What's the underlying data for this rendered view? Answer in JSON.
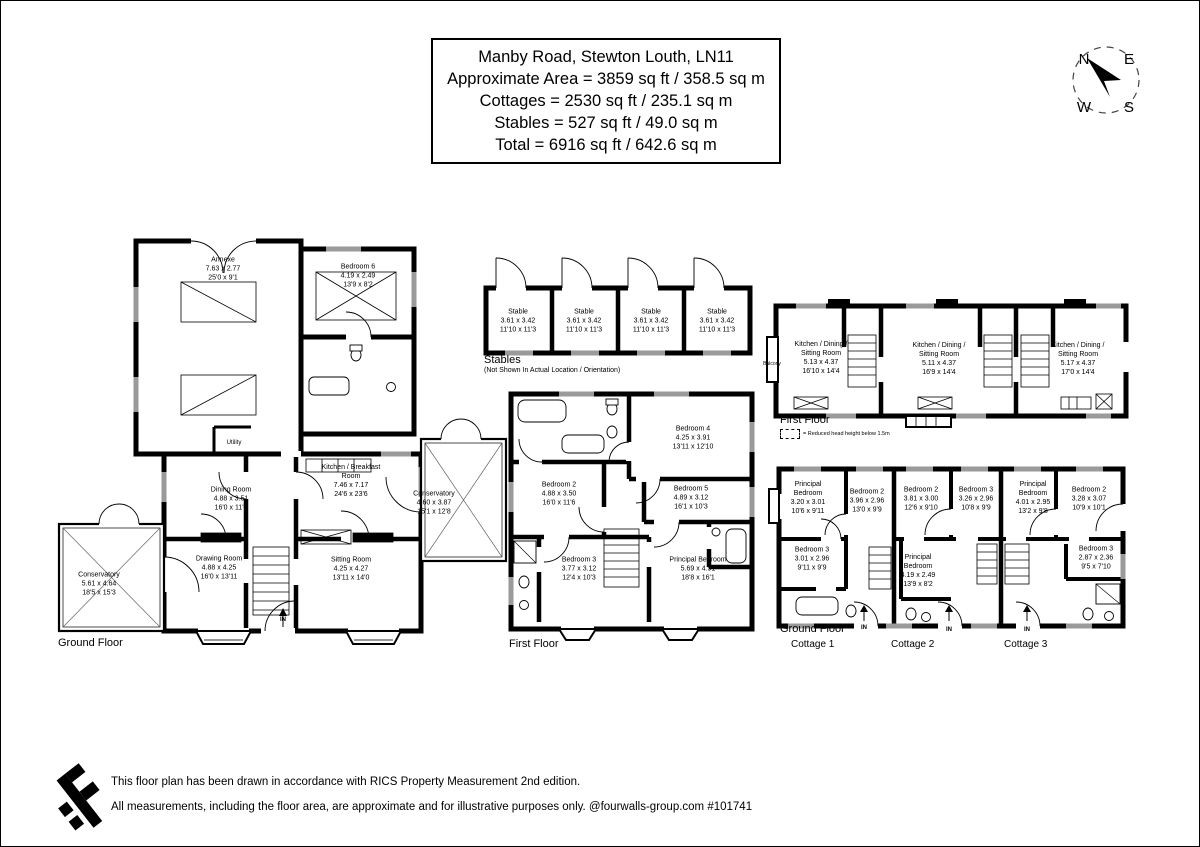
{
  "title_box": {
    "line1": "Manby Road, Stewton Louth, LN11",
    "line2": "Approximate Area = 3859 sq ft / 358.5 sq m",
    "line3": "Cottages = 2530 sq ft / 235.1 sq m",
    "line4": "Stables = 527 sq ft / 49.0 sq m",
    "line5": "Total = 6916 sq ft / 642.6 sq m"
  },
  "compass": {
    "n": "N",
    "e": "E",
    "w": "W",
    "s": "S"
  },
  "colors": {
    "wall": "#000000",
    "window": "#9a9a9a",
    "background": "#ffffff"
  },
  "plans": {
    "main_ground": {
      "caption": "Ground Floor",
      "entrance_label": "IN",
      "rooms": [
        {
          "name": "Annexe",
          "metric": "7.63 x 2.77",
          "imperial": "25'0 x 9'1"
        },
        {
          "name": "Bedroom 6",
          "metric": "4.19 x 2.49",
          "imperial": "13'9 x 8'2"
        },
        {
          "name": "Utility",
          "metric": "",
          "imperial": ""
        },
        {
          "name": "Dining Room",
          "metric": "4.88 x 3.51",
          "imperial": "16'0 x 11'6"
        },
        {
          "name": "Kitchen / Breakfast Room",
          "metric": "7.46 x 7.17",
          "imperial": "24'6 x 23'6"
        },
        {
          "name": "Drawing Room",
          "metric": "4.88 x 4.25",
          "imperial": "16'0 x 13'11"
        },
        {
          "name": "Sitting Room",
          "metric": "4.25 x 4.27",
          "imperial": "13'11 x 14'0"
        },
        {
          "name": "Conservatory",
          "metric": "4.60 x 3.87",
          "imperial": "15'1 x 12'8"
        },
        {
          "name": "Conservatory",
          "metric": "5.61 x 4.64",
          "imperial": "18'5 x 15'3"
        }
      ]
    },
    "main_first": {
      "caption": "First Floor",
      "rooms": [
        {
          "name": "Bedroom 4",
          "metric": "4.25 x 3.91",
          "imperial": "13'11 x 12'10"
        },
        {
          "name": "Bedroom 2",
          "metric": "4.88 x 3.50",
          "imperial": "16'0 x 11'6"
        },
        {
          "name": "Bedroom 5",
          "metric": "4.89 x 3.12",
          "imperial": "16'1 x 10'3"
        },
        {
          "name": "Bedroom 3",
          "metric": "3.77 x 3.12",
          "imperial": "12'4 x 10'3"
        },
        {
          "name": "Principal Bedroom",
          "metric": "5.69 x 4.91",
          "imperial": "18'8 x 16'1"
        }
      ]
    },
    "stables": {
      "caption": "Stables",
      "subcaption": "(Not Shown In Actual Location / Orientation)",
      "stalls": [
        {
          "name": "Stable",
          "metric": "3.61 x 3.42",
          "imperial": "11'10 x 11'3"
        },
        {
          "name": "Stable",
          "metric": "3.61 x 3.42",
          "imperial": "11'10 x 11'3"
        },
        {
          "name": "Stable",
          "metric": "3.61 x 3.42",
          "imperial": "11'10 x 11'3"
        },
        {
          "name": "Stable",
          "metric": "3.61 x 3.42",
          "imperial": "11'10 x 11'3"
        }
      ]
    },
    "cottages_first": {
      "caption": "First Floor",
      "legend_text": "= Reduced head height below 1.5m",
      "balcony_label": "Balcony",
      "rooms": [
        {
          "name": "Kitchen / Dining / Sitting Room",
          "metric": "5.13 x 4.37",
          "imperial": "16'10 x 14'4"
        },
        {
          "name": "Kitchen / Dining / Sitting Room",
          "metric": "5.11 x 4.37",
          "imperial": "16'9 x 14'4"
        },
        {
          "name": "Kitchen / Dining / Sitting Room",
          "metric": "5.17 x 4.37",
          "imperial": "17'0 x 14'4"
        }
      ]
    },
    "cottages_ground": {
      "caption": "Ground Floor",
      "entrance_label": "IN",
      "cottage_labels": [
        "Cottage 1",
        "Cottage 2",
        "Cottage 3"
      ],
      "rooms": [
        {
          "name": "Principal Bedroom",
          "metric": "3.20 x 3.01",
          "imperial": "10'6 x 9'11"
        },
        {
          "name": "Bedroom 2",
          "metric": "3.96 x 2.96",
          "imperial": "13'0 x 9'9"
        },
        {
          "name": "Bedroom 3",
          "metric": "3.01 x 2.96",
          "imperial": "9'11 x 9'9"
        },
        {
          "name": "Bedroom 2",
          "metric": "3.81 x 3.00",
          "imperial": "12'6 x 9'10"
        },
        {
          "name": "Principal Bedroom",
          "metric": "4.19 x 2.49",
          "imperial": "13'9 x 8'2"
        },
        {
          "name": "Bedroom 3",
          "metric": "3.26 x 2.96",
          "imperial": "10'8 x 9'9"
        },
        {
          "name": "Principal Bedroom",
          "metric": "4.01 x 2.95",
          "imperial": "13'2 x 9'8"
        },
        {
          "name": "Bedroom 2",
          "metric": "3.28 x 3.07",
          "imperial": "10'9 x 10'1"
        },
        {
          "name": "Bedroom 3",
          "metric": "2.87 x 2.36",
          "imperial": "9'5 x 7'10"
        }
      ]
    }
  },
  "footer": {
    "line1": "This floor plan has been drawn in accordance with RICS Property Measurement 2nd edition.",
    "line2": "All measurements, including the floor area, are approximate and for illustrative purposes only. @fourwalls-group.com #101741"
  }
}
